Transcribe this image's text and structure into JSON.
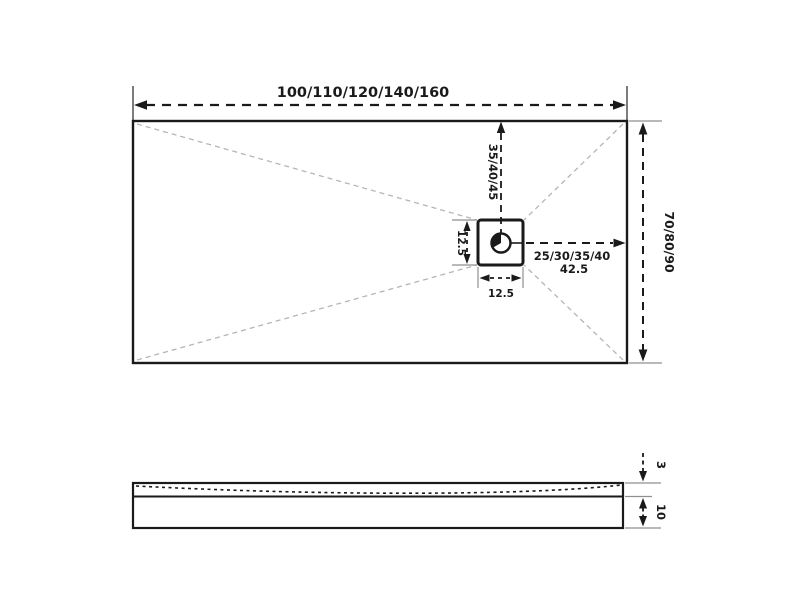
{
  "top_view": {
    "width_label": "100/110/120/140/160",
    "height_label": "70/80/90",
    "drain_to_top_label": "35/40/45",
    "drain_to_right_label": "25/30/35/40",
    "drain_to_right_value": "42.5",
    "drain_height_label": "12.5",
    "drain_width_label": "12.5"
  },
  "side_view": {
    "surface_thickness_label": "3",
    "base_thickness_label": "10"
  },
  "colors": {
    "line": "#1a1a1a",
    "extension": "#8f8f8f",
    "diagonal": "#b5b5b5",
    "background": "#ffffff"
  }
}
